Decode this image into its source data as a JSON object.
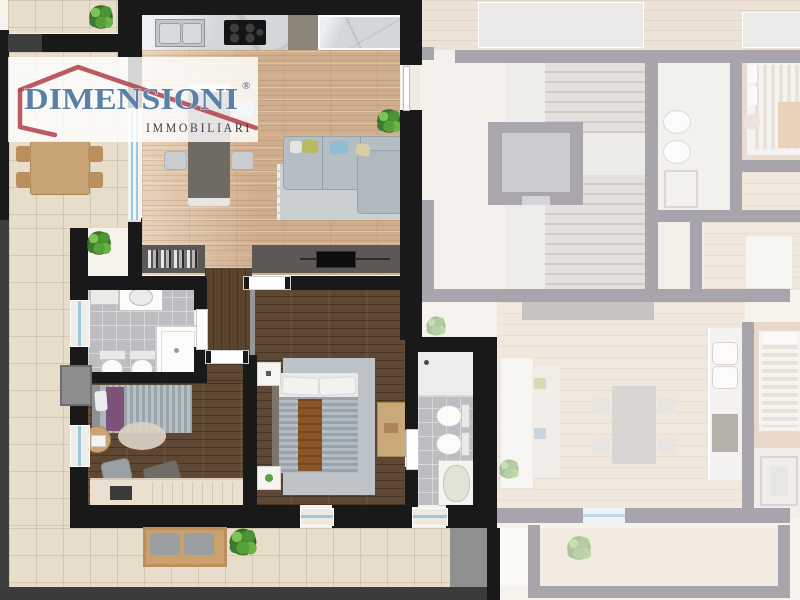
{
  "logo": {
    "brand": "DIMENSIONI",
    "registered": "®",
    "subtitle": "IMMOBILIARI",
    "brand_color": "#5b80a8",
    "roof_color": "#b2444c",
    "subtitle_color": "#3e3e49",
    "band_color": "rgba(255,255,255,0.82)"
  },
  "palette": {
    "wall_black": "#191919",
    "wall_faded": "#a8a4ab",
    "wood_living": "#cfae8e",
    "wood_dark": "#5e4733",
    "terrace_tile": "#e7ddca",
    "bath_tile": "#bdbdc1",
    "marble": "#d2d7da",
    "sofa_gray": "#b5bec2",
    "rug_gray": "#cad0d2",
    "window_glass": "#9ec8dd",
    "plant_green": "#58a03c",
    "faded_floor": "#f2ece4"
  }
}
